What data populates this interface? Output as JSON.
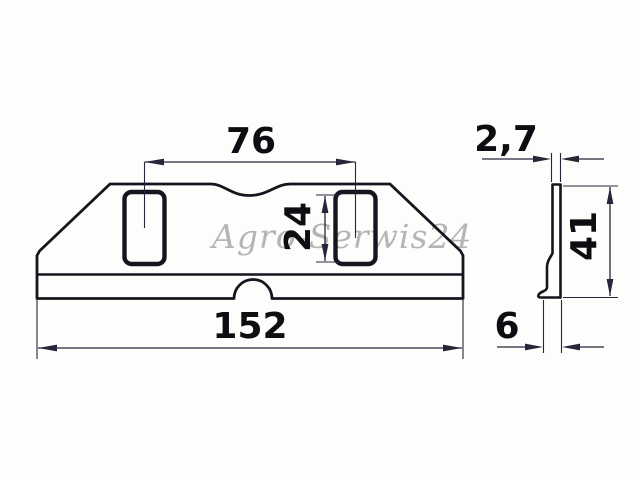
{
  "watermark": {
    "text": "Agro-Serwis24"
  },
  "dimensions": {
    "slot_spacing": "76",
    "slot_length": "24",
    "overall_length": "152",
    "thickness": "2,7",
    "height": "41",
    "edge_width": "6"
  },
  "colors": {
    "background": "#fdfdfb",
    "outline": "#15151f",
    "dimension": "#26263a",
    "label": "#0d0d12",
    "watermark": "#a9a9a9"
  }
}
